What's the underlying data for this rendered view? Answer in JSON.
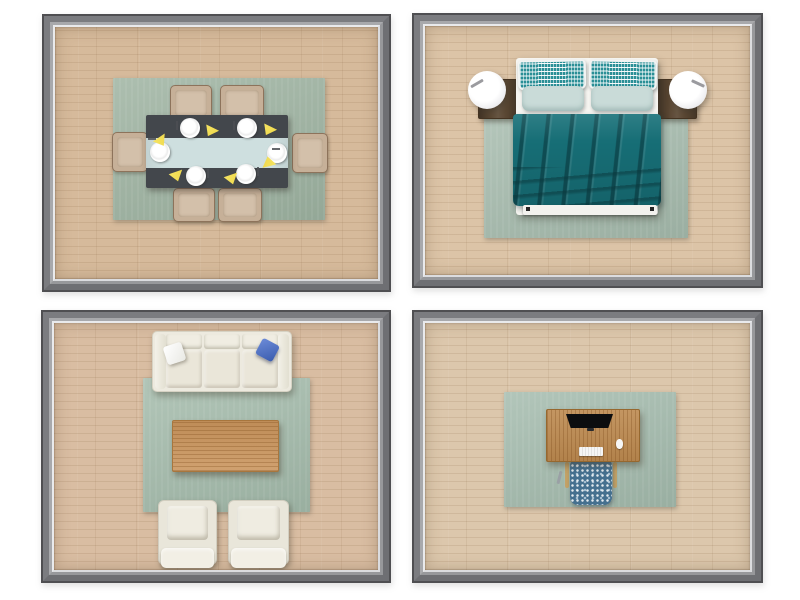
{
  "scene": {
    "type": "3d-floor-plan-grid",
    "layout": "2x2",
    "rooms": [
      {
        "id": "dining-room",
        "position": "top-left",
        "furniture": [
          "area-rug",
          "dining-table",
          "table-runner",
          "dining-chair x6",
          "place-setting x6",
          "yellow-napkin x6"
        ]
      },
      {
        "id": "bedroom",
        "position": "top-right",
        "furniture": [
          "area-rug",
          "double-bed",
          "teal-blanket",
          "patterned-pillow x2",
          "plain-pillow x2",
          "nightstand x2",
          "table-lamp x2"
        ]
      },
      {
        "id": "living-room",
        "position": "bottom-left",
        "furniture": [
          "area-rug",
          "three-seat-sofa",
          "white-throw-pillow",
          "blue-throw-pillow",
          "wood-coffee-table",
          "armchair x2"
        ]
      },
      {
        "id": "home-office",
        "position": "bottom-right",
        "furniture": [
          "area-rug",
          "wood-desk",
          "monitor",
          "keyboard",
          "mouse",
          "office-chair"
        ]
      }
    ]
  },
  "colors": {
    "background": "#ffffff",
    "wall_edge": "#4f4f52",
    "wall_mid": "#7b7c80",
    "wall_mid_shade": "#6e6f73",
    "wall_light": "#a8a9ac",
    "wall_light_shade": "#97989b",
    "wall_lip": "#e9eaec",
    "wall_lip_shade": "#dbdcdf",
    "wood_dining": "#d6ba9b",
    "wood_bedroom": "#dcc4a7",
    "wood_living": "#d9bda2",
    "wood_office": "#dcc7ac",
    "rug_dining": "#a3b7a6",
    "rug_bedroom": "#abbfb2",
    "rug_living": "#a9bfb0",
    "rug_office": "#a9bfb2",
    "dining_table": "#43474c",
    "table_runner": "#cedfdf",
    "napkin_yellow": "#eed747",
    "dining_chair": "#c6b098",
    "nightstand_brown": "#5a4733",
    "lamp_white": "#ffffff",
    "bed_white": "#f6f5f1",
    "pillow_teal_pattern": "#2a8f96",
    "pillow_plain": "#c9dbd8",
    "blanket_teal": "#177078",
    "sofa_cream": "#edeadf",
    "pillow_white": "#e9e9e4",
    "pillow_blue": "#3a5cae",
    "coffee_table_oak": "#c9945c",
    "desk_oak": "#bd8a50",
    "monitor_black": "#0c0d0f",
    "keyboard_white": "#f5f5f4",
    "office_chair_blue": "#45708f",
    "armrest_tan": "#c3a267"
  }
}
